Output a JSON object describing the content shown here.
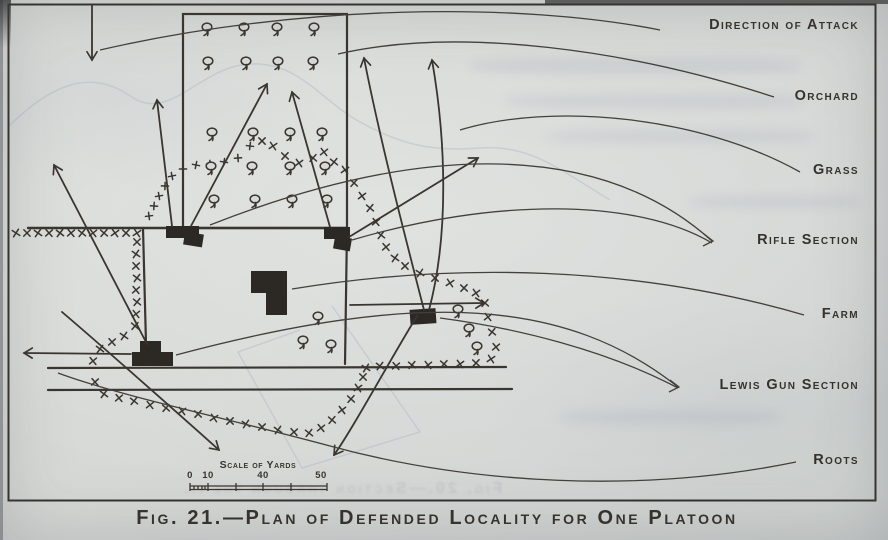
{
  "figure": {
    "caption": "Fig. 21.—Plan of Defended Locality for One Platoon",
    "ghost_text": "Fig. 20.—Section through the ...",
    "ink_color": "#3a352e",
    "paper_color": "#d7dad6",
    "labels": [
      {
        "id": "direction-of-attack",
        "text": "Direction of Attack",
        "top": 17
      },
      {
        "id": "orchard",
        "text": "Orchard",
        "top": 88
      },
      {
        "id": "grass",
        "text": "Grass",
        "top": 162
      },
      {
        "id": "rifle-section",
        "text": "Rifle Section",
        "top": 232
      },
      {
        "id": "farm",
        "text": "Farm",
        "top": 306
      },
      {
        "id": "lewis-gun-section",
        "text": "Lewis Gun Section",
        "top": 377
      },
      {
        "id": "roots",
        "text": "Roots",
        "top": 452
      }
    ],
    "scale": {
      "title": "Scale of Yards",
      "ticks": [
        {
          "label": "0",
          "x": 190
        },
        {
          "label": "10",
          "x": 208
        },
        {
          "label": "40",
          "x": 263
        },
        {
          "label": "50",
          "x": 321
        }
      ]
    }
  },
  "map": {
    "border": {
      "x": 8.5,
      "y": 4.5,
      "w": 867,
      "h": 496
    },
    "orchard_rect": {
      "x": 183,
      "y": 14,
      "w": 164,
      "h": 214
    },
    "roads": [
      {
        "d": "M 28,228 L 347,228",
        "w": 2.4
      },
      {
        "d": "M 48,368 L 506,367",
        "w": 2.2
      },
      {
        "d": "M 48,390 L 512,389",
        "w": 2.2
      },
      {
        "d": "M 143,228 L 146,344",
        "w": 2.2
      },
      {
        "d": "M 347,228 L 345,364",
        "w": 2.2
      }
    ],
    "buildings": [
      {
        "x": 166,
        "y": 226,
        "w": 33,
        "h": 12,
        "r": 0
      },
      {
        "x": 184,
        "y": 233,
        "w": 19,
        "h": 13,
        "r": 9
      },
      {
        "x": 324,
        "y": 227,
        "w": 26,
        "h": 12,
        "r": 0
      },
      {
        "x": 334,
        "y": 237,
        "w": 17,
        "h": 13,
        "r": 10
      },
      {
        "x": 251,
        "y": 271,
        "w": 36,
        "h": 22,
        "r": 0
      },
      {
        "x": 266,
        "y": 290,
        "w": 21,
        "h": 25,
        "r": 0
      },
      {
        "x": 140,
        "y": 341,
        "w": 21,
        "h": 13,
        "r": 0
      },
      {
        "x": 132,
        "y": 352,
        "w": 41,
        "h": 14,
        "r": 0
      },
      {
        "x": 410,
        "y": 309,
        "w": 26,
        "h": 15,
        "r": -4
      }
    ],
    "trees": [
      [
        207,
        29
      ],
      [
        244,
        29
      ],
      [
        277,
        29
      ],
      [
        314,
        29
      ],
      [
        208,
        63
      ],
      [
        246,
        63
      ],
      [
        278,
        63
      ],
      [
        313,
        63
      ],
      [
        212,
        134
      ],
      [
        253,
        134
      ],
      [
        290,
        134
      ],
      [
        322,
        134
      ],
      [
        211,
        168
      ],
      [
        252,
        168
      ],
      [
        290,
        168
      ],
      [
        325,
        168
      ],
      [
        214,
        201
      ],
      [
        255,
        201
      ],
      [
        292,
        201
      ],
      [
        327,
        201
      ],
      [
        318,
        318
      ],
      [
        303,
        342
      ],
      [
        331,
        346
      ],
      [
        458,
        311
      ],
      [
        469,
        330
      ],
      [
        477,
        348
      ]
    ],
    "wire": [
      {
        "glyph": "x",
        "pts": [
          [
            16,
            233
          ],
          [
            27,
            233
          ],
          [
            38,
            233
          ],
          [
            49,
            233
          ],
          [
            60,
            233
          ],
          [
            71,
            233
          ],
          [
            82,
            233
          ],
          [
            93,
            233
          ],
          [
            104,
            233
          ],
          [
            115,
            233
          ],
          [
            126,
            233
          ],
          [
            137,
            233
          ]
        ]
      },
      {
        "glyph": "x",
        "pts": [
          [
            137,
            242
          ],
          [
            136,
            254
          ],
          [
            136,
            266
          ],
          [
            137,
            278
          ],
          [
            136,
            290
          ],
          [
            137,
            302
          ],
          [
            136,
            314
          ],
          [
            135,
            326
          ]
        ]
      },
      {
        "glyph": "x",
        "pts": [
          [
            124,
            336
          ],
          [
            112,
            342
          ],
          [
            100,
            349
          ],
          [
            93,
            361
          ]
        ]
      },
      {
        "glyph": "x",
        "pts": [
          [
            95,
            382
          ],
          [
            104,
            394
          ],
          [
            119,
            398
          ],
          [
            134,
            401
          ],
          [
            150,
            405
          ],
          [
            166,
            408
          ],
          [
            182,
            411
          ],
          [
            198,
            414
          ],
          [
            214,
            418
          ],
          [
            230,
            421
          ],
          [
            246,
            424
          ],
          [
            262,
            427
          ],
          [
            278,
            430
          ],
          [
            294,
            432
          ],
          [
            309,
            433
          ],
          [
            321,
            428
          ],
          [
            332,
            420
          ],
          [
            342,
            410
          ],
          [
            351,
            399
          ],
          [
            358,
            388
          ],
          [
            363,
            377
          ],
          [
            366,
            368
          ]
        ]
      },
      {
        "glyph": "x",
        "pts": [
          [
            380,
            366
          ],
          [
            396,
            366
          ],
          [
            412,
            365
          ],
          [
            428,
            365
          ],
          [
            444,
            364
          ],
          [
            460,
            364
          ],
          [
            476,
            363
          ],
          [
            491,
            359
          ]
        ]
      },
      {
        "glyph": "x",
        "pts": [
          [
            496,
            347
          ],
          [
            492,
            332
          ],
          [
            488,
            317
          ],
          [
            485,
            303
          ],
          [
            476,
            293
          ],
          [
            464,
            288
          ],
          [
            450,
            283
          ],
          [
            435,
            278
          ],
          [
            420,
            273
          ],
          [
            405,
            266
          ],
          [
            395,
            258
          ],
          [
            386,
            247
          ],
          [
            381,
            235
          ],
          [
            376,
            222
          ],
          [
            370,
            208
          ],
          [
            362,
            196
          ],
          [
            354,
            183
          ],
          [
            345,
            170
          ]
        ]
      },
      {
        "glyph": "x",
        "pts": [
          [
            334,
            162
          ],
          [
            324,
            152
          ],
          [
            313,
            158
          ],
          [
            299,
            163
          ],
          [
            285,
            156
          ],
          [
            273,
            146
          ],
          [
            262,
            141
          ]
        ]
      },
      {
        "glyph": "+",
        "pts": [
          [
            250,
            146
          ],
          [
            238,
            158
          ],
          [
            224,
            162
          ],
          [
            210,
            164
          ],
          [
            196,
            165
          ],
          [
            183,
            169
          ],
          [
            172,
            176
          ],
          [
            165,
            186
          ],
          [
            159,
            196
          ],
          [
            154,
            206
          ],
          [
            149,
            216
          ]
        ]
      }
    ],
    "arrows": [
      {
        "id": "attack-arrow",
        "d": "M 92,6 L 92,60"
      },
      {
        "id": "fire-left-rifle-n",
        "d": "M 172,226 L 157,100"
      },
      {
        "id": "fire-left-rifle-ne",
        "d": "M 191,226 L 267,84"
      },
      {
        "id": "fire-right-rifle-nw",
        "d": "M 330,227 L 292,92"
      },
      {
        "id": "fire-right-rifle-ne",
        "d": "M 349,237 L 478,158"
      },
      {
        "id": "fire-right-lewis-n1",
        "d": "M 424,310 C 406,240 380,140 364,58"
      },
      {
        "id": "fire-right-lewis-n2",
        "d": "M 429,310 C 449,235 446,140 432,60"
      },
      {
        "id": "fire-left-lewis-nw",
        "d": "M 147,344 L 54,165"
      },
      {
        "id": "fire-left-lewis-w",
        "d": "M 131,354 L 24,353"
      },
      {
        "id": "fire-se",
        "d": "M 62,312 C 95,340 180,415 219,450"
      },
      {
        "id": "fire-right-lewis-sw",
        "d": "M 417,316 C 390,360 352,430 334,455"
      },
      {
        "id": "fire-east",
        "d": "M 350,305 L 484,303"
      }
    ],
    "leaders": [
      {
        "d": "M 660,30 C 520,2 300,4 100,50"
      },
      {
        "d": "M 774,97 C 630,50 460,26 338,54"
      },
      {
        "d": "M 800,172 C 700,116 552,102 460,130"
      },
      {
        "d": "M 712,241 C 600,140 420,142 210,225"
      },
      {
        "d": "M 712,243 C 636,198 494,198 352,240"
      },
      {
        "d": "M 804,315 C 636,266 456,262 292,289"
      },
      {
        "d": "M 678,387 C 566,298 420,290 176,355"
      },
      {
        "d": "M 678,388 C 606,350 516,328 440,318"
      },
      {
        "d": "M 796,462 C 640,494 470,484 330,446 C 230,419 120,396 58,373"
      }
    ],
    "leader_tips": [
      {
        "d": "M 704,234 L 713,241 L 703,246"
      },
      {
        "d": "M 670,380 L 679,387 L 669,392"
      }
    ],
    "ghost_paths": [
      {
        "d": "M 238,352 L 302,468 L 420,432 M 332,306 L 420,432 M 238,352 L 300,330"
      },
      {
        "d": "M 8,127 C 50,85 90,68 130,96 S 200,66 250,64 S 320,100 360,122 S 430,152 480,148 S 560,170 610,200"
      }
    ],
    "scale_bar": {
      "x1": 190,
      "x2": 327,
      "y": 486,
      "major_ticks": [
        190,
        208,
        236,
        263,
        291,
        327
      ],
      "minor_ticks": [
        194,
        198,
        202,
        205
      ]
    }
  }
}
